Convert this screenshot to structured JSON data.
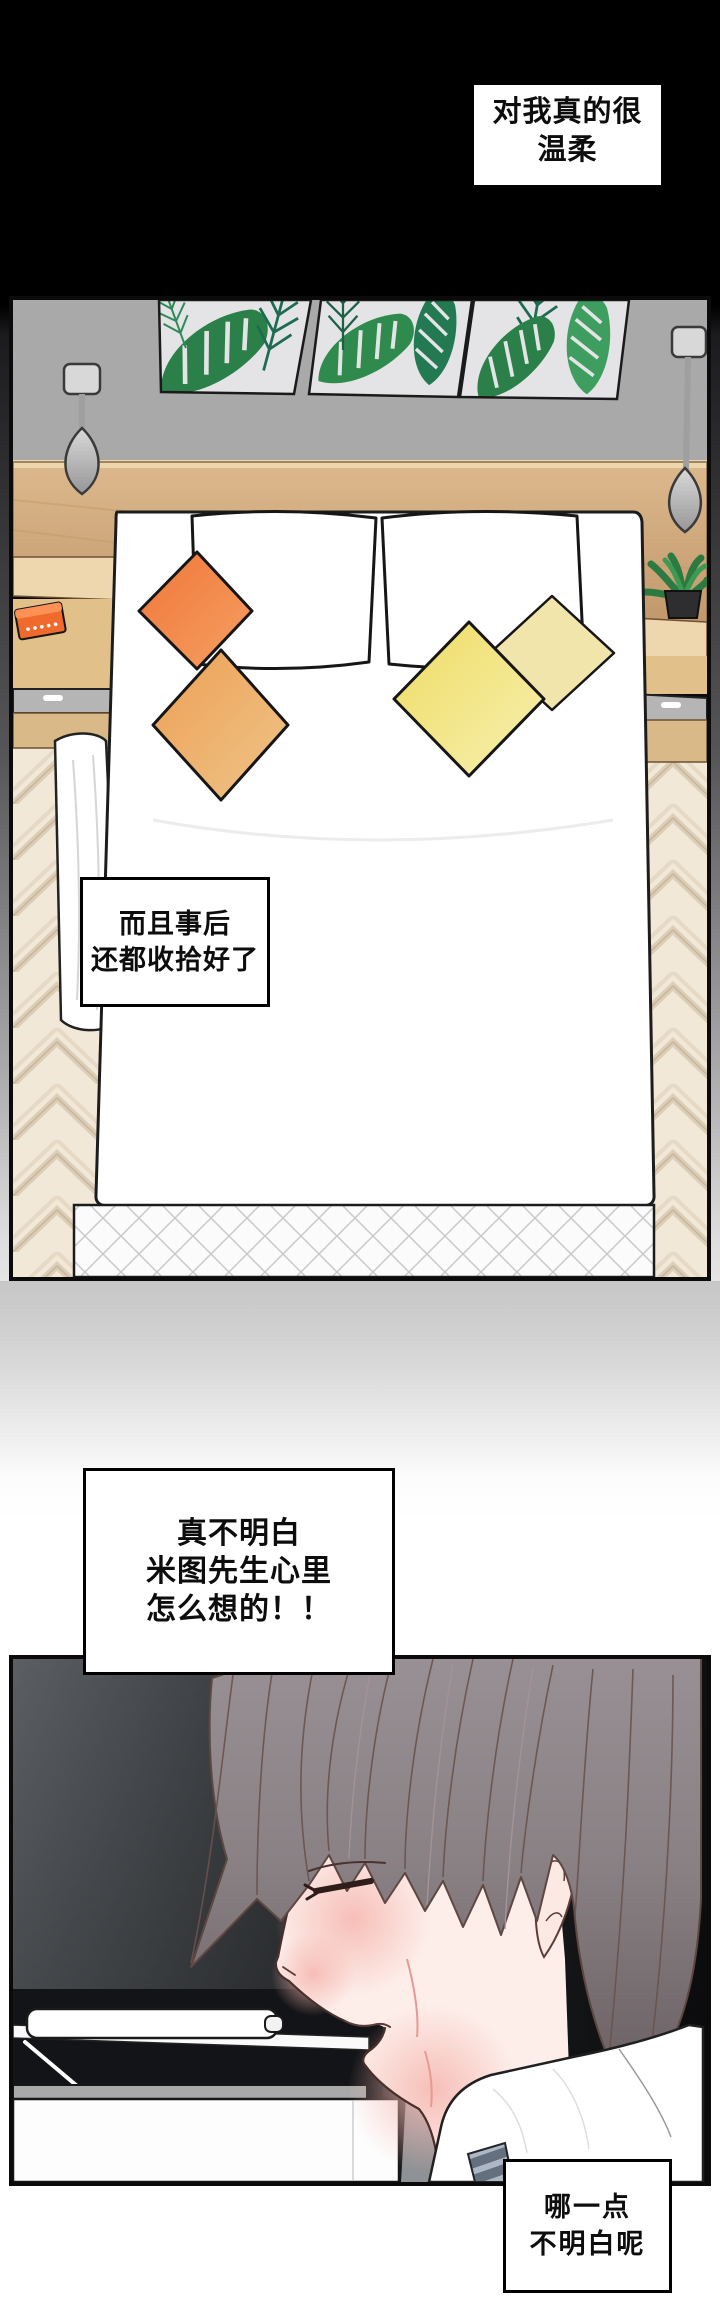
{
  "page": {
    "width": 720,
    "height": 2318,
    "type": "webtoon-comic-page",
    "background_top": "#000000",
    "background_bottom": "#ffffff"
  },
  "bubbles": [
    {
      "name": "bubble-gentle",
      "lines": [
        "对我真的很",
        "温柔"
      ]
    },
    {
      "name": "bubble-tidy",
      "lines": [
        "而且事后",
        "还都收拾好了"
      ]
    },
    {
      "name": "bubble-confused",
      "lines": [
        "真不明白",
        "米图先生心里",
        "怎么想的！！"
      ]
    },
    {
      "name": "bubble-reply",
      "lines": [
        "哪一点",
        "不明白呢"
      ]
    }
  ],
  "panels": [
    {
      "name": "bedroom-panel",
      "description": "overhead view of tidy bed",
      "objects": [
        "leaf-wall-art-x3",
        "wall-lamp-left",
        "wall-lamp-right",
        "headboard-shelf",
        "nightstand-left",
        "orange-radio",
        "nightstand-right",
        "potted-plant",
        "bed-duvet",
        "white-pillow-left",
        "white-pillow-right",
        "orange-pillow",
        "amber-pillow",
        "yellow-pillow",
        "pale-yellow-pillow",
        "quilted-mattress-edge",
        "sheet-fold",
        "herringbone-floor"
      ]
    },
    {
      "name": "profile-panel",
      "description": "young man in profile, eyes closed, at desk",
      "objects": [
        "hair",
        "face",
        "closed-eye",
        "ear",
        "lips",
        "blush",
        "collar-shirt",
        "striped-tie",
        "chair-back",
        "desk",
        "closed-laptop",
        "white-pen",
        "drawer-front"
      ]
    }
  ],
  "colors": {
    "wall_gray": "#a9a9aa",
    "wood_headboard": "#cfa87a",
    "nightstand_wood": "#e6c89a",
    "leaf_green_dark": "#2b8049",
    "leaf_green_teal": "#1d6b51",
    "orange_pillow": "#ef7438",
    "amber_pillow": "#eca153",
    "yellow_pillow": "#eedc63",
    "pale_yellow_pillow": "#f1e5ab",
    "orange_radio": "#f16a2d",
    "floor_beige": "#f2e8d7",
    "panel2_bg_left": "#5b5f63",
    "panel2_bg_right": "#0e0f11",
    "hair": "#8f868a",
    "skin": "#fdeeea",
    "blush_pink": "#f6b9b2",
    "tie_dark": "#65707e",
    "tie_light": "#aeb8c4"
  }
}
